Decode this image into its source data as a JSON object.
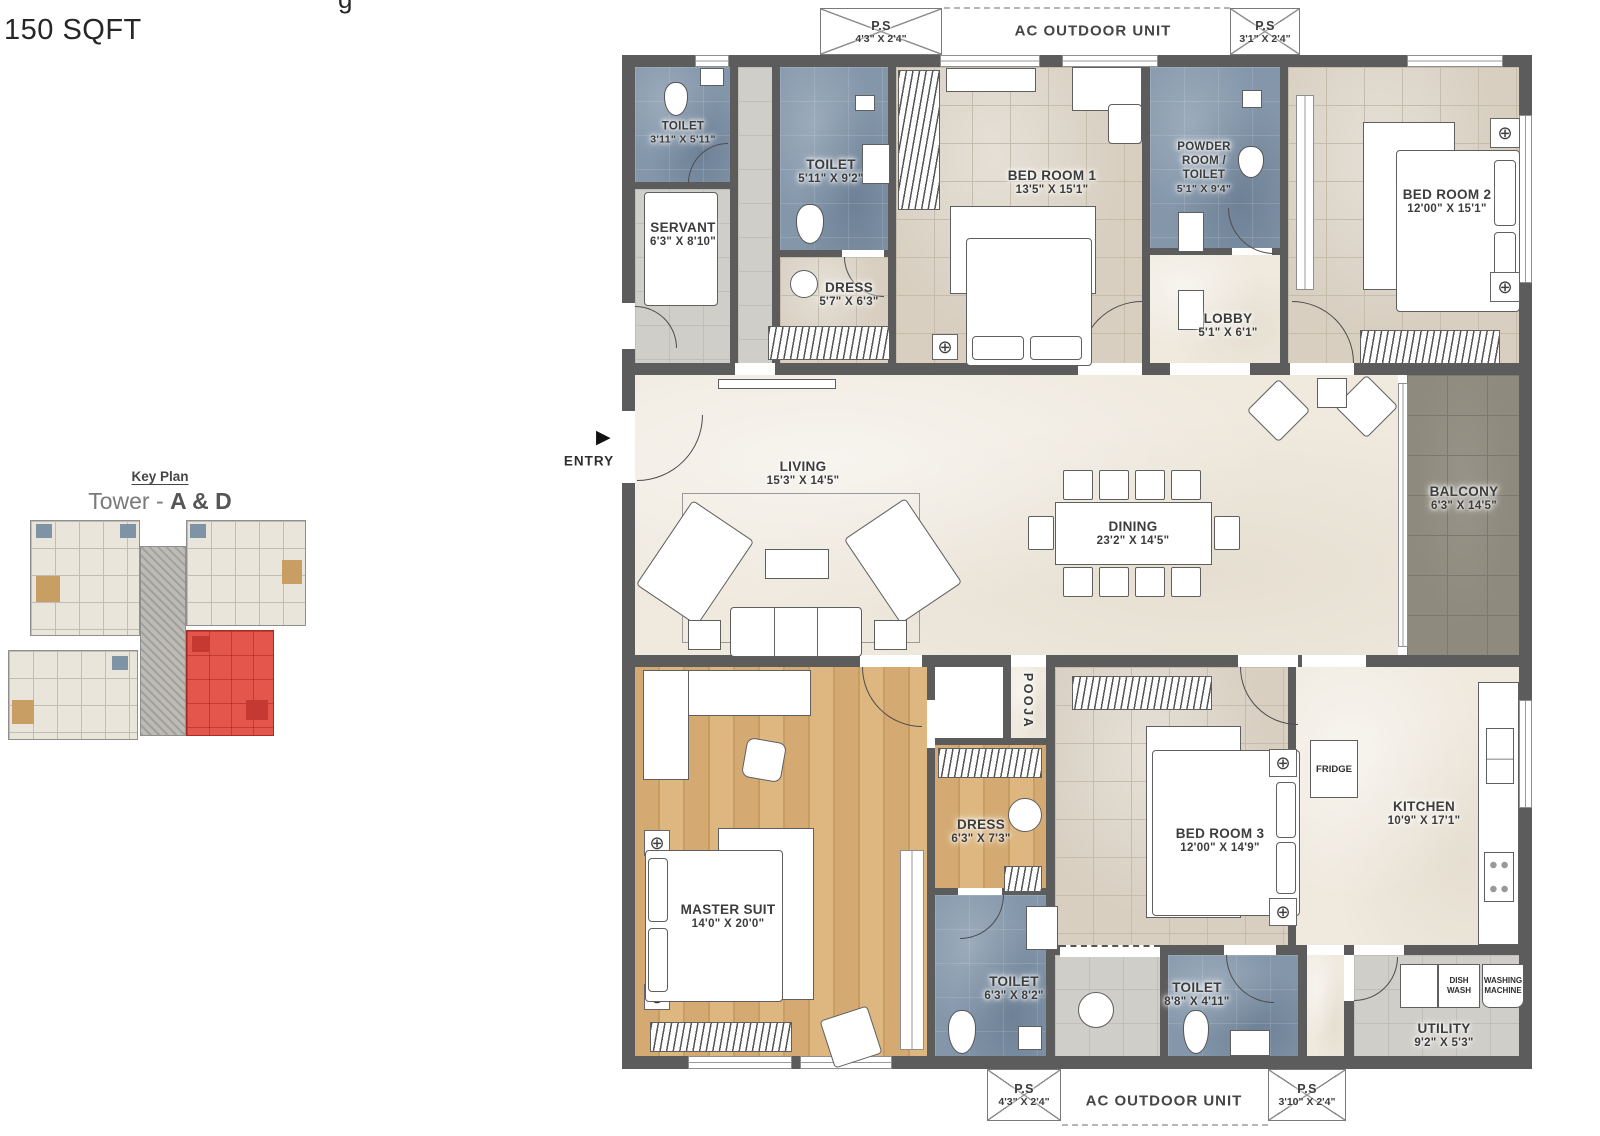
{
  "header": {
    "area_text": "150 SQFT",
    "clipped_fragment": "g"
  },
  "key_plan": {
    "title": "Key Plan",
    "subtitle_light": "Tower - ",
    "subtitle_bold": "A & D"
  },
  "strips": {
    "top": {
      "ps_left": {
        "name": "P.S",
        "dims": "4'3\" X 2'4\""
      },
      "ac_label": "AC OUTDOOR UNIT",
      "ps_right": {
        "name": "P.S",
        "dims": "3'1\" X 2'4\""
      }
    },
    "bottom": {
      "ps_left": {
        "name": "P.S",
        "dims": "4'3\" X 2'4\""
      },
      "ac_label": "AC OUTDOOR UNIT",
      "ps_right": {
        "name": "P.S",
        "dims": "3'10\" X 2'4\""
      }
    }
  },
  "entry": {
    "label": "ENTRY"
  },
  "rooms": [
    {
      "id": "toilet-servant",
      "name": "TOILET",
      "dims": "3'11\" X 5'11\""
    },
    {
      "id": "servant",
      "name": "SERVANT",
      "dims": "6'3\" X 8'10\""
    },
    {
      "id": "toilet-common",
      "name": "TOILET",
      "dims": "5'11\" X 9'2\""
    },
    {
      "id": "dress-1",
      "name": "DRESS",
      "dims": "5'7\" X 6'3\""
    },
    {
      "id": "bedroom-1",
      "name": "BED ROOM 1",
      "dims": "13'5\" X 15'1\""
    },
    {
      "id": "powder-room",
      "name": "POWDER ROOM / TOILET",
      "dims": "5'1\" X 9'4\""
    },
    {
      "id": "lobby",
      "name": "LOBBY",
      "dims": "5'1\" X 6'1\""
    },
    {
      "id": "bedroom-2",
      "name": "BED ROOM 2",
      "dims": "12'00\" X 15'1\""
    },
    {
      "id": "living",
      "name": "LIVING",
      "dims": "15'3\" X 14'5\""
    },
    {
      "id": "dining",
      "name": "DINING",
      "dims": "23'2\" X 14'5\""
    },
    {
      "id": "balcony",
      "name": "BALCONY",
      "dims": "6'3\" X 14'5\""
    },
    {
      "id": "pooja",
      "name": "POOJA",
      "dims": ""
    },
    {
      "id": "master-suit",
      "name": "MASTER SUIT",
      "dims": "14'0\" X 20'0\""
    },
    {
      "id": "dress-2",
      "name": "DRESS",
      "dims": "6'3\" X 7'3\""
    },
    {
      "id": "toilet-master",
      "name": "TOILET",
      "dims": "6'3\" X 8'2\""
    },
    {
      "id": "bedroom-3",
      "name": "BED ROOM 3",
      "dims": "12'00\" X 14'9\""
    },
    {
      "id": "kitchen",
      "name": "KITCHEN",
      "dims": "10'9\" X 17'1\""
    },
    {
      "id": "toilet-bed3",
      "name": "TOILET",
      "dims": "8'8\" X 4'11\""
    },
    {
      "id": "utility",
      "name": "UTILITY",
      "dims": "9'2\" X 5'3\""
    }
  ],
  "fixtures": {
    "fridge": "FRIDGE",
    "dish_wash": "DISH WASH",
    "washing_machine": "WASHING MACHINE"
  },
  "icons": {
    "fan": "⊕",
    "entry_arrow": "▶"
  },
  "colors": {
    "wall": "#5c5c5c",
    "toilet_floor": "#8396aa",
    "bedroom_floor": "#d8cfc1",
    "living_floor": "#efe9de",
    "wood_floor": "#d0a76f",
    "balcony_floor": "#8e8a7e",
    "service_floor": "#cfcec8",
    "keyplan_highlight": "#e4564c",
    "label_text": "#3c3c3c"
  }
}
